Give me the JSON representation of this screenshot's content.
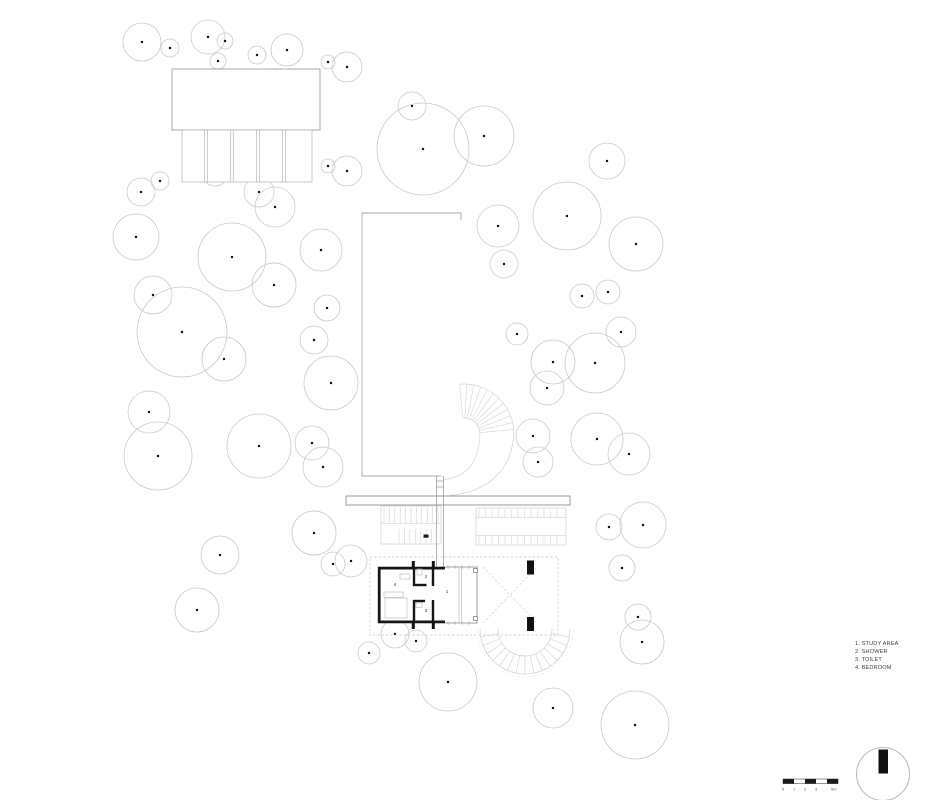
{
  "legend": {
    "items": [
      "1. STUDY AREA",
      "2. SHOWER",
      "3. TOILET",
      "4. BEDROOM"
    ]
  },
  "scale_bar": {
    "labels": [
      "0",
      "1",
      "2",
      "3",
      "5m"
    ]
  },
  "plan": {
    "room_labels": [
      {
        "n": "1",
        "x": 447,
        "y": 593
      },
      {
        "n": "2",
        "x": 426,
        "y": 578
      },
      {
        "n": "3",
        "x": 426,
        "y": 612
      },
      {
        "n": "4",
        "x": 395,
        "y": 586
      }
    ],
    "trees": [
      [
        142,
        42,
        19
      ],
      [
        170,
        48,
        9
      ],
      [
        208,
        37,
        17
      ],
      [
        225,
        41,
        8
      ],
      [
        218,
        61,
        8
      ],
      [
        257,
        55,
        9
      ],
      [
        287,
        50,
        16
      ],
      [
        328,
        62,
        7
      ],
      [
        347,
        67,
        15
      ],
      [
        412,
        106,
        14
      ],
      [
        423,
        149,
        46
      ],
      [
        484,
        136,
        30
      ],
      [
        607,
        161,
        18
      ],
      [
        141,
        192,
        14
      ],
      [
        160,
        181,
        9
      ],
      [
        215,
        173,
        13
      ],
      [
        259,
        192,
        15
      ],
      [
        328,
        166,
        7
      ],
      [
        347,
        171,
        15
      ],
      [
        136,
        237,
        23
      ],
      [
        275,
        207,
        20
      ],
      [
        232,
        257,
        34
      ],
      [
        274,
        285,
        22
      ],
      [
        321,
        250,
        21
      ],
      [
        153,
        295,
        19
      ],
      [
        182,
        332,
        45
      ],
      [
        224,
        359,
        22
      ],
      [
        327,
        308,
        13
      ],
      [
        314,
        340,
        14
      ],
      [
        331,
        383,
        27
      ],
      [
        149,
        412,
        21
      ],
      [
        158,
        456,
        34
      ],
      [
        259,
        446,
        32
      ],
      [
        312,
        443,
        17
      ],
      [
        323,
        467,
        20
      ],
      [
        498,
        226,
        21
      ],
      [
        567,
        216,
        34
      ],
      [
        636,
        244,
        27
      ],
      [
        504,
        264,
        14
      ],
      [
        582,
        296,
        12
      ],
      [
        608,
        292,
        12
      ],
      [
        517,
        334,
        11
      ],
      [
        553,
        362,
        22
      ],
      [
        595,
        363,
        30
      ],
      [
        621,
        332,
        15
      ],
      [
        547,
        388,
        17
      ],
      [
        533,
        436,
        17
      ],
      [
        538,
        462,
        15
      ],
      [
        597,
        439,
        26
      ],
      [
        629,
        454,
        21
      ],
      [
        609,
        527,
        13
      ],
      [
        643,
        525,
        23
      ],
      [
        220,
        555,
        19
      ],
      [
        197,
        610,
        22
      ],
      [
        314,
        533,
        22
      ],
      [
        333,
        564,
        12
      ],
      [
        351,
        561,
        16
      ],
      [
        369,
        653,
        11
      ],
      [
        395,
        634,
        14
      ],
      [
        416,
        641,
        11
      ],
      [
        448,
        682,
        29
      ],
      [
        553,
        708,
        20
      ],
      [
        622,
        568,
        13
      ],
      [
        638,
        617,
        13
      ],
      [
        642,
        642,
        22
      ],
      [
        635,
        725,
        34
      ]
    ]
  },
  "colors": {
    "tree_stroke": "#c9c9c9",
    "wall": "#161616",
    "line": "#9a9a9a",
    "light_line": "#c6c6c6",
    "dash": "#c2c2c2"
  }
}
